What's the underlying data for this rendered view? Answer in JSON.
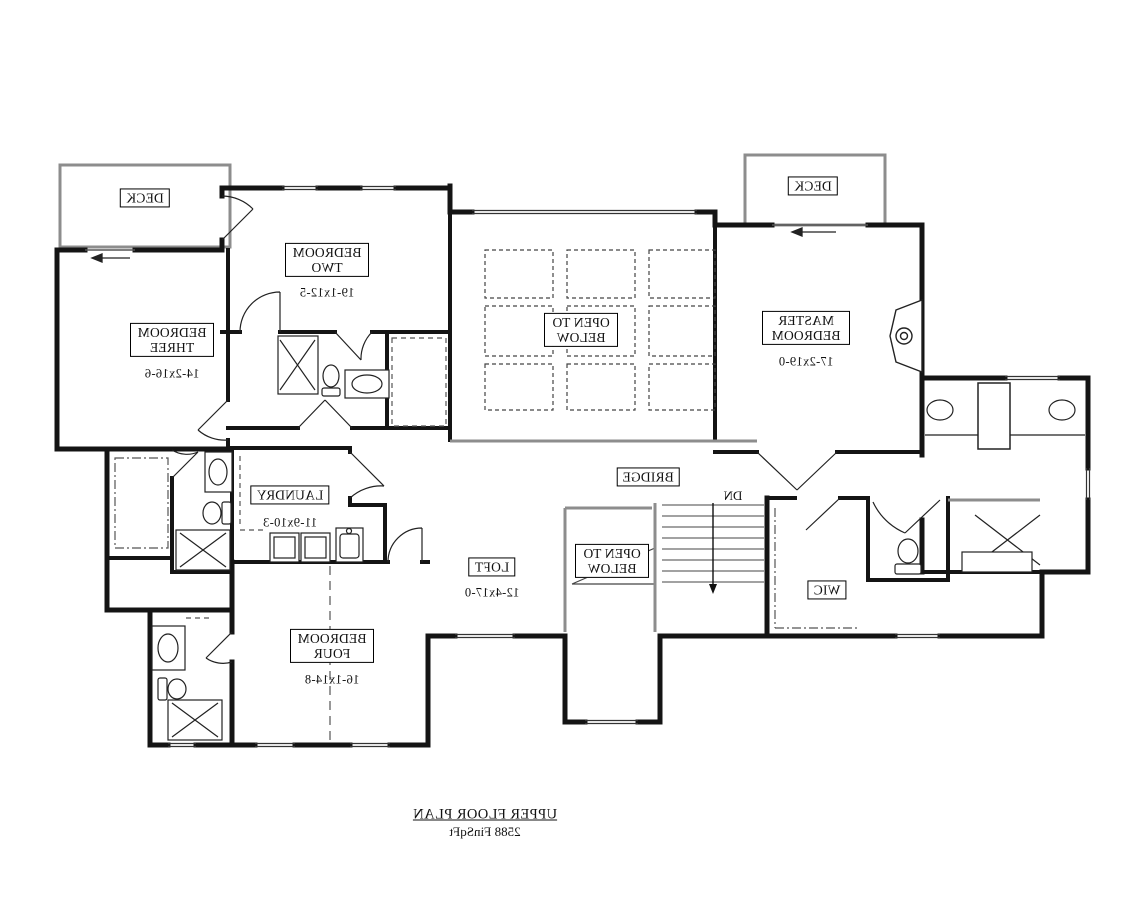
{
  "meta": {
    "sheet_title": "UPPER FLOOR PLAN",
    "sheet_area": "2588 FinSqFt",
    "orientation": "mirrored"
  },
  "rooms": {
    "deck_left": {
      "name": "DECK"
    },
    "deck_right": {
      "name": "DECK"
    },
    "bedroom_two": {
      "name": "BEDROOM TWO",
      "dims": "19-1x12-5"
    },
    "bedroom_three": {
      "name": "BEDROOM THREE",
      "dims": "14-2x16-6"
    },
    "master_bedroom": {
      "name": "MASTER BEDROOM",
      "dims": "17-2x19-0"
    },
    "bedroom_four": {
      "name": "BEDROOM FOUR",
      "dims": "16-1x14-8"
    },
    "laundry": {
      "name": "LAUNDRY",
      "dims": "11-9x10-3"
    },
    "loft": {
      "name": "LOFT",
      "dims": "12-4x17-0"
    },
    "bridge": {
      "name": "BRIDGE"
    },
    "wic": {
      "name": "WIC"
    },
    "open_below_upper": {
      "name": "OPEN TO BELOW"
    },
    "open_below_lower": {
      "name": "OPEN TO BELOW"
    },
    "stairs": {
      "label": "DN"
    }
  },
  "colors": {
    "wall": "#141414",
    "thin_line": "#333333",
    "rail_gray": "#8d8d8d",
    "dash": "#555555",
    "background": "#ffffff"
  }
}
